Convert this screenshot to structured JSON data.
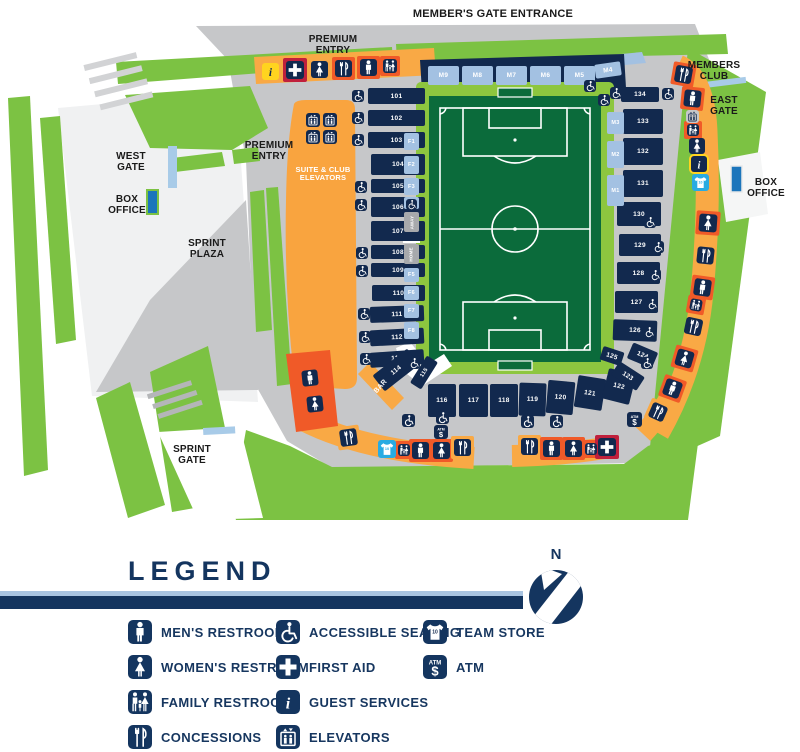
{
  "map": {
    "colors": {
      "navy": "#12294e",
      "lightblue": "#a3c1e2",
      "green": "#7cc243",
      "pitch": "#0b6b3b",
      "field_border": "#8dc63f",
      "gray": "#c6c7c9",
      "light_orange": "#f9a945",
      "dark_orange": "#f05a28",
      "yellow": "#ffd41f",
      "red": "#c0203c",
      "store_blue": "#29abe2",
      "legend_text": "#16365f",
      "box_office_blue": "#1b75bb"
    },
    "labels": [
      {
        "id": "members-gate-entrance",
        "t": "MEMBER'S GATE ENTRANCE",
        "x": 493,
        "y": 8,
        "s": 11,
        "w": 260
      },
      {
        "id": "premium-entry-top",
        "t": "PREMIUM\nENTRY",
        "x": 333,
        "y": 34,
        "s": 10,
        "w": 90
      },
      {
        "id": "premium-entry-left",
        "t": "PREMIUM\nENTRY",
        "x": 269,
        "y": 140,
        "s": 10,
        "w": 90
      },
      {
        "id": "west-gate",
        "t": "WEST\nGATE",
        "x": 131,
        "y": 151,
        "s": 10,
        "w": 70
      },
      {
        "id": "box-office-west",
        "t": "BOX\nOFFICE",
        "x": 127,
        "y": 194,
        "s": 10,
        "w": 70
      },
      {
        "id": "sprint-plaza",
        "t": "SPRINT\nPLAZA",
        "x": 207,
        "y": 238,
        "s": 10,
        "w": 80
      },
      {
        "id": "sprint-gate",
        "t": "SPRINT\nGATE",
        "x": 192,
        "y": 444,
        "s": 10,
        "w": 70
      },
      {
        "id": "members-club",
        "t": "MEMBERS\nCLUB",
        "x": 714,
        "y": 60,
        "s": 10,
        "w": 84
      },
      {
        "id": "east-gate",
        "t": "EAST\nGATE",
        "x": 724,
        "y": 95,
        "s": 10,
        "w": 60
      },
      {
        "id": "box-office-east",
        "t": "BOX\nOFFICE",
        "x": 766,
        "y": 177,
        "s": 10,
        "w": 62
      },
      {
        "id": "suite-club-elevators",
        "t": "SUITE & CLUB\nELEVATORS",
        "x": 323,
        "y": 166,
        "s": 7.5,
        "w": 74,
        "c": "#ffffff"
      },
      {
        "id": "bar-label",
        "t": "BAR",
        "x": 381,
        "y": 383,
        "s": 7,
        "w": 30,
        "c": "#ffffff",
        "rot": -48
      }
    ],
    "sections": [
      {
        "n": "101",
        "x": 368,
        "y": 88,
        "w": 57,
        "h": 16
      },
      {
        "n": "102",
        "x": 368,
        "y": 110,
        "w": 57,
        "h": 16
      },
      {
        "n": "103",
        "x": 368,
        "y": 132,
        "w": 57,
        "h": 16
      },
      {
        "n": "104",
        "x": 371,
        "y": 154,
        "w": 54,
        "h": 21
      },
      {
        "n": "105",
        "x": 371,
        "y": 179,
        "w": 54,
        "h": 14
      },
      {
        "n": "106",
        "x": 371,
        "y": 197,
        "w": 54,
        "h": 20
      },
      {
        "n": "107",
        "x": 371,
        "y": 221,
        "w": 54,
        "h": 20
      },
      {
        "n": "108",
        "x": 371,
        "y": 245,
        "w": 54,
        "h": 14
      },
      {
        "n": "109",
        "x": 371,
        "y": 263,
        "w": 54,
        "h": 14
      },
      {
        "n": "110",
        "x": 372,
        "y": 285,
        "w": 53,
        "h": 16
      },
      {
        "n": "111",
        "x": 370,
        "y": 306,
        "w": 54,
        "h": 16,
        "r": -2
      },
      {
        "n": "112",
        "x": 370,
        "y": 329,
        "w": 54,
        "h": 16,
        "r": -3
      },
      {
        "n": "113",
        "x": 370,
        "y": 351,
        "w": 54,
        "h": 15,
        "r": -4
      },
      {
        "n": "114",
        "x": 374,
        "y": 360,
        "w": 44,
        "h": 20,
        "r": -38
      },
      {
        "n": "115",
        "x": 408,
        "y": 366,
        "w": 32,
        "h": 13,
        "r": -58
      },
      {
        "n": "116",
        "x": 428,
        "y": 384,
        "w": 28,
        "h": 33
      },
      {
        "n": "117",
        "x": 459,
        "y": 384,
        "w": 29,
        "h": 33
      },
      {
        "n": "118",
        "x": 490,
        "y": 384,
        "w": 28,
        "h": 33
      },
      {
        "n": "119",
        "x": 519,
        "y": 383,
        "w": 27,
        "h": 33,
        "r": 2
      },
      {
        "n": "120",
        "x": 547,
        "y": 381,
        "w": 27,
        "h": 33,
        "r": 5
      },
      {
        "n": "121",
        "x": 576,
        "y": 377,
        "w": 28,
        "h": 32,
        "r": 9
      },
      {
        "n": "122",
        "x": 605,
        "y": 371,
        "w": 28,
        "h": 31,
        "r": 14
      },
      {
        "n": "123",
        "x": 613,
        "y": 368,
        "w": 30,
        "h": 16,
        "r": 33
      },
      {
        "n": "124",
        "x": 629,
        "y": 347,
        "w": 27,
        "h": 17,
        "r": 23
      },
      {
        "n": "125",
        "x": 601,
        "y": 349,
        "w": 22,
        "h": 14,
        "r": 18
      },
      {
        "n": "126",
        "x": 613,
        "y": 320,
        "w": 44,
        "h": 21,
        "r": 2
      },
      {
        "n": "127",
        "x": 615,
        "y": 291,
        "w": 43,
        "h": 22
      },
      {
        "n": "128",
        "x": 617,
        "y": 262,
        "w": 43,
        "h": 22
      },
      {
        "n": "129",
        "x": 619,
        "y": 234,
        "w": 42,
        "h": 22
      },
      {
        "n": "130",
        "x": 617,
        "y": 202,
        "w": 44,
        "h": 24
      },
      {
        "n": "131",
        "x": 623,
        "y": 170,
        "w": 40,
        "h": 27
      },
      {
        "n": "132",
        "x": 623,
        "y": 138,
        "w": 40,
        "h": 27
      },
      {
        "n": "133",
        "x": 623,
        "y": 109,
        "w": 40,
        "h": 25
      },
      {
        "n": "134",
        "x": 621,
        "y": 87,
        "w": 38,
        "h": 15
      },
      {
        "n": "M9",
        "x": 428,
        "y": 66,
        "w": 31,
        "h": 19,
        "c": "b"
      },
      {
        "n": "M8",
        "x": 462,
        "y": 66,
        "w": 31,
        "h": 19,
        "c": "b"
      },
      {
        "n": "M7",
        "x": 496,
        "y": 66,
        "w": 31,
        "h": 19,
        "c": "b"
      },
      {
        "n": "M6",
        "x": 530,
        "y": 66,
        "w": 31,
        "h": 19,
        "c": "b"
      },
      {
        "n": "M5",
        "x": 564,
        "y": 66,
        "w": 31,
        "h": 19,
        "c": "b"
      },
      {
        "n": "M4",
        "x": 595,
        "y": 63,
        "w": 26,
        "h": 14,
        "c": "b",
        "r": -8
      },
      {
        "n": "M3",
        "x": 607,
        "y": 112,
        "w": 17,
        "h": 22,
        "c": "b"
      },
      {
        "n": "M2",
        "x": 607,
        "y": 141,
        "w": 17,
        "h": 27,
        "c": "b"
      },
      {
        "n": "M1",
        "x": 607,
        "y": 175,
        "w": 17,
        "h": 31,
        "c": "b"
      },
      {
        "n": "F1",
        "x": 404,
        "y": 133,
        "w": 15,
        "h": 17,
        "c": "b"
      },
      {
        "n": "F2",
        "x": 404,
        "y": 156,
        "w": 15,
        "h": 18,
        "c": "b"
      },
      {
        "n": "F3",
        "x": 404,
        "y": 178,
        "w": 15,
        "h": 17,
        "c": "b"
      },
      {
        "n": "F4",
        "x": 404,
        "y": 197,
        "w": 15,
        "h": 12,
        "c": "b"
      },
      {
        "n": "AWAY",
        "x": 404,
        "y": 212,
        "w": 15,
        "h": 20,
        "c": "g",
        "vert": true
      },
      {
        "n": "HOME",
        "x": 404,
        "y": 244,
        "w": 15,
        "h": 20,
        "c": "g",
        "vert": true
      },
      {
        "n": "F5",
        "x": 404,
        "y": 268,
        "w": 15,
        "h": 14,
        "c": "b"
      },
      {
        "n": "F6",
        "x": 404,
        "y": 286,
        "w": 15,
        "h": 14,
        "c": "b"
      },
      {
        "n": "F7",
        "x": 404,
        "y": 304,
        "w": 15,
        "h": 14,
        "c": "b"
      },
      {
        "n": "F8",
        "x": 404,
        "y": 322,
        "w": 15,
        "h": 17,
        "c": "b"
      }
    ],
    "icons": [
      {
        "t": "info",
        "x": 262,
        "y": 63,
        "s": 17,
        "bg": "yellow"
      },
      {
        "t": "aid",
        "x": 286,
        "y": 61,
        "s": 18,
        "bg": "navy",
        "wrap": "red"
      },
      {
        "t": "womens",
        "x": 311,
        "y": 61,
        "s": 17,
        "bg": "navy"
      },
      {
        "t": "conc",
        "x": 335,
        "y": 60,
        "s": 17,
        "bg": "navy",
        "wrap": "dk"
      },
      {
        "t": "mens",
        "x": 360,
        "y": 59,
        "s": 17,
        "bg": "navy",
        "wrap": "dk"
      },
      {
        "t": "family",
        "x": 383,
        "y": 59,
        "s": 14,
        "bg": "navy",
        "wrap": "dk"
      },
      {
        "t": "elev",
        "x": 306,
        "y": 113,
        "s": 14,
        "bg": "navy"
      },
      {
        "t": "elev",
        "x": 323,
        "y": 113,
        "s": 14,
        "bg": "navy"
      },
      {
        "t": "elev",
        "x": 306,
        "y": 130,
        "s": 14,
        "bg": "navy"
      },
      {
        "t": "elev",
        "x": 323,
        "y": 130,
        "s": 14,
        "bg": "navy"
      },
      {
        "t": "conc",
        "x": 675,
        "y": 66,
        "s": 17,
        "bg": "navy",
        "wrap": "dk",
        "r": 10
      },
      {
        "t": "mens",
        "x": 684,
        "y": 90,
        "s": 17,
        "bg": "navy",
        "wrap": "dk",
        "r": 6
      },
      {
        "t": "elev",
        "x": 686,
        "y": 110,
        "s": 13,
        "bg": "gray"
      },
      {
        "t": "family",
        "x": 687,
        "y": 124,
        "s": 12,
        "bg": "navy",
        "wrap": "dk"
      },
      {
        "t": "womens",
        "x": 689,
        "y": 138,
        "s": 16,
        "bg": "navy"
      },
      {
        "t": "info",
        "x": 691,
        "y": 156,
        "s": 16,
        "bg": "navy",
        "wrap": "yl"
      },
      {
        "t": "store",
        "x": 692,
        "y": 174,
        "s": 17,
        "bg": "blue"
      },
      {
        "t": "womens",
        "x": 699,
        "y": 214,
        "s": 18,
        "bg": "navy",
        "wrap": "dk",
        "r": 4
      },
      {
        "t": "conc",
        "x": 697,
        "y": 247,
        "s": 17,
        "bg": "navy",
        "r": 6
      },
      {
        "t": "mens",
        "x": 694,
        "y": 279,
        "s": 17,
        "bg": "navy",
        "wrap": "dk",
        "r": 8
      },
      {
        "t": "family",
        "x": 690,
        "y": 299,
        "s": 12,
        "bg": "navy",
        "wrap": "dk",
        "r": 10
      },
      {
        "t": "conc",
        "x": 685,
        "y": 318,
        "s": 17,
        "bg": "navy",
        "r": 12
      },
      {
        "t": "womens",
        "x": 676,
        "y": 350,
        "s": 17,
        "bg": "navy",
        "wrap": "dk",
        "r": 16
      },
      {
        "t": "mens",
        "x": 664,
        "y": 380,
        "s": 17,
        "bg": "navy",
        "wrap": "dk",
        "r": 20
      },
      {
        "t": "conc",
        "x": 650,
        "y": 404,
        "s": 16,
        "bg": "navy",
        "wrap": "lt",
        "r": 24
      },
      {
        "t": "atm",
        "x": 627,
        "y": 412,
        "s": 15,
        "bg": "navy"
      },
      {
        "t": "acc",
        "x": 521,
        "y": 415,
        "s": 13,
        "bg": "navy"
      },
      {
        "t": "acc",
        "x": 550,
        "y": 415,
        "s": 13,
        "bg": "navy"
      },
      {
        "t": "conc",
        "x": 521,
        "y": 438,
        "s": 17,
        "bg": "navy",
        "wrap": "lt"
      },
      {
        "t": "mens",
        "x": 543,
        "y": 440,
        "s": 17,
        "bg": "navy",
        "wrap": "dk"
      },
      {
        "t": "womens",
        "x": 565,
        "y": 440,
        "s": 17,
        "bg": "navy",
        "wrap": "dk"
      },
      {
        "t": "family",
        "x": 585,
        "y": 443,
        "s": 12,
        "bg": "navy",
        "wrap": "dk"
      },
      {
        "t": "aid",
        "x": 598,
        "y": 438,
        "s": 18,
        "bg": "navy",
        "wrap": "red"
      },
      {
        "t": "acc",
        "x": 402,
        "y": 414,
        "s": 13,
        "bg": "navy"
      },
      {
        "t": "acc",
        "x": 436,
        "y": 411,
        "s": 13,
        "bg": "navy"
      },
      {
        "t": "atm",
        "x": 434,
        "y": 425,
        "s": 14,
        "bg": "navy"
      },
      {
        "t": "conc",
        "x": 340,
        "y": 429,
        "s": 17,
        "bg": "navy",
        "wrap": "lt",
        "r": -8
      },
      {
        "t": "store",
        "x": 378,
        "y": 440,
        "s": 18,
        "bg": "blue"
      },
      {
        "t": "family",
        "x": 398,
        "y": 444,
        "s": 12,
        "bg": "navy",
        "wrap": "dk"
      },
      {
        "t": "mens",
        "x": 412,
        "y": 442,
        "s": 17,
        "bg": "navy",
        "wrap": "dk"
      },
      {
        "t": "womens",
        "x": 433,
        "y": 442,
        "s": 17,
        "bg": "navy",
        "wrap": "dk"
      },
      {
        "t": "conc",
        "x": 454,
        "y": 439,
        "s": 17,
        "bg": "navy",
        "wrap": "lt"
      },
      {
        "t": "mens",
        "x": 302,
        "y": 370,
        "s": 16,
        "bg": "navy",
        "r": -6
      },
      {
        "t": "womens",
        "x": 307,
        "y": 396,
        "s": 16,
        "bg": "navy",
        "r": -6
      },
      {
        "t": "acc",
        "x": 352,
        "y": 90,
        "s": 12,
        "bg": "navy"
      },
      {
        "t": "acc",
        "x": 352,
        "y": 112,
        "s": 12,
        "bg": "navy"
      },
      {
        "t": "acc",
        "x": 352,
        "y": 134,
        "s": 12,
        "bg": "navy"
      },
      {
        "t": "acc",
        "x": 355,
        "y": 181,
        "s": 12,
        "bg": "navy"
      },
      {
        "t": "acc",
        "x": 355,
        "y": 199,
        "s": 12,
        "bg": "navy"
      },
      {
        "t": "acc",
        "x": 356,
        "y": 247,
        "s": 12,
        "bg": "navy"
      },
      {
        "t": "acc",
        "x": 356,
        "y": 265,
        "s": 12,
        "bg": "navy"
      },
      {
        "t": "acc",
        "x": 358,
        "y": 308,
        "s": 12,
        "bg": "navy"
      },
      {
        "t": "acc",
        "x": 359,
        "y": 331,
        "s": 12,
        "bg": "navy"
      },
      {
        "t": "acc",
        "x": 360,
        "y": 353,
        "s": 12,
        "bg": "navy"
      },
      {
        "t": "acc",
        "x": 406,
        "y": 199,
        "s": 11,
        "bg": "navy"
      },
      {
        "t": "acc",
        "x": 584,
        "y": 80,
        "s": 12,
        "bg": "navy"
      },
      {
        "t": "acc",
        "x": 598,
        "y": 94,
        "s": 12,
        "bg": "navy"
      },
      {
        "t": "acc",
        "x": 610,
        "y": 87,
        "s": 12,
        "bg": "navy"
      },
      {
        "t": "acc",
        "x": 662,
        "y": 88,
        "s": 12,
        "bg": "navy"
      },
      {
        "t": "acc",
        "x": 644,
        "y": 216,
        "s": 12,
        "bg": "navy"
      },
      {
        "t": "acc",
        "x": 652,
        "y": 241,
        "s": 12,
        "bg": "navy"
      },
      {
        "t": "acc",
        "x": 649,
        "y": 269,
        "s": 12,
        "bg": "navy"
      },
      {
        "t": "acc",
        "x": 646,
        "y": 298,
        "s": 12,
        "bg": "navy"
      },
      {
        "t": "acc",
        "x": 643,
        "y": 326,
        "s": 12,
        "bg": "navy"
      },
      {
        "t": "acc",
        "x": 641,
        "y": 357,
        "s": 12,
        "bg": "navy"
      },
      {
        "t": "acc",
        "x": 408,
        "y": 357,
        "s": 12,
        "bg": "navy"
      }
    ]
  },
  "legend": {
    "title": "LEGEND",
    "north_label": "N",
    "columns": [
      [
        {
          "icon": "mens",
          "label": "MEN'S RESTROOM"
        },
        {
          "icon": "womens",
          "label": "WOMEN'S RESTROOM"
        },
        {
          "icon": "family",
          "label": "FAMILY RESTROOM"
        },
        {
          "icon": "conc",
          "label": "CONCESSIONS"
        }
      ],
      [
        {
          "icon": "acc",
          "label": "ACCESSIBLE SEATING"
        },
        {
          "icon": "aid",
          "label": "FIRST AID"
        },
        {
          "icon": "info",
          "label": "GUEST SERVICES"
        },
        {
          "icon": "elev",
          "label": "ELEVATORS"
        }
      ],
      [
        {
          "icon": "store",
          "label": "TEAM STORE"
        },
        {
          "icon": "atm",
          "label": "ATM"
        }
      ]
    ]
  }
}
